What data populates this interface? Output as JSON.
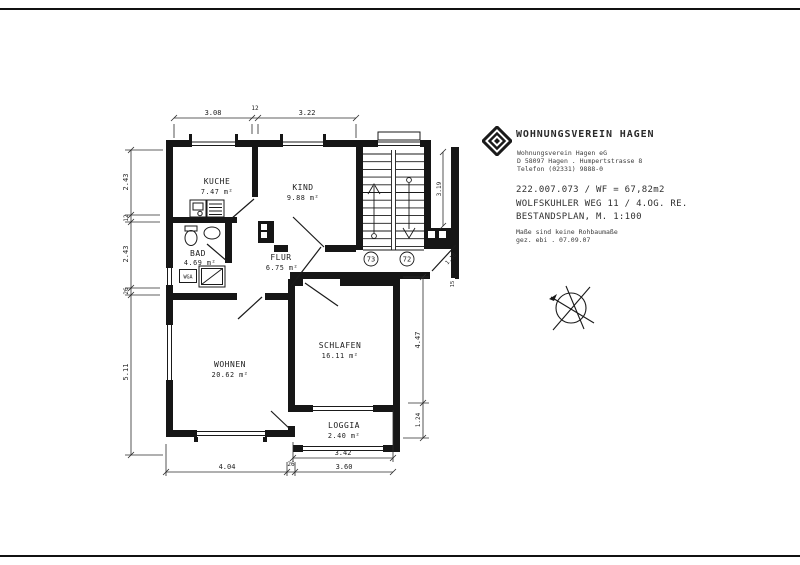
{
  "header": {
    "company_title": "WOHNUNGSVEREIN HAGEN",
    "address_lines": [
      "Wohnungsverein Hagen eG",
      "D 58097 Hagen . Humpertstrasse 8",
      "Telefon (02331) 9888-0"
    ],
    "ref_line1": "222.007.073 / WF = 67,82m2",
    "ref_line2": "WOLFSKUHLER WEG 11 / 4.OG. RE.",
    "ref_line3": "BESTANDSPLAN, M. 1:100",
    "note_line1": "Maße sind keine Rohbaumaße",
    "note_line2": "gez. ebi . 07.09.07"
  },
  "plan": {
    "rooms": {
      "kueche": {
        "name": "KUCHE",
        "area": "7.47 m²"
      },
      "kind": {
        "name": "KIND",
        "area": "9.88 m²"
      },
      "bad": {
        "name": "BAD",
        "area": "4.69 m²"
      },
      "flur": {
        "name": "FLUR",
        "area": "6.75 m²"
      },
      "wohnen": {
        "name": "WOHNEN",
        "area": "20.62 m²"
      },
      "schlafen": {
        "name": "SCHLAFEN",
        "area": "16.11 m²"
      },
      "loggia": {
        "name": "LOGGIA",
        "area": "2.40 m²"
      }
    },
    "labels": {
      "wga": "WGA"
    },
    "doors": {
      "left_badge": "73",
      "right_badge": "72"
    },
    "dims": {
      "top": [
        "3.08",
        "12",
        "3.22"
      ],
      "left": [
        "2.43",
        "12",
        "2.43",
        "26",
        "5.11"
      ],
      "right": [
        "4.47",
        "1.24"
      ],
      "bottom_inner": "3.42",
      "bottom_outer": [
        "4.04",
        "26",
        "3.60"
      ],
      "stair": "3.19",
      "entry": "1.18",
      "entry2": "15"
    },
    "ink": "#1a1a1a"
  }
}
